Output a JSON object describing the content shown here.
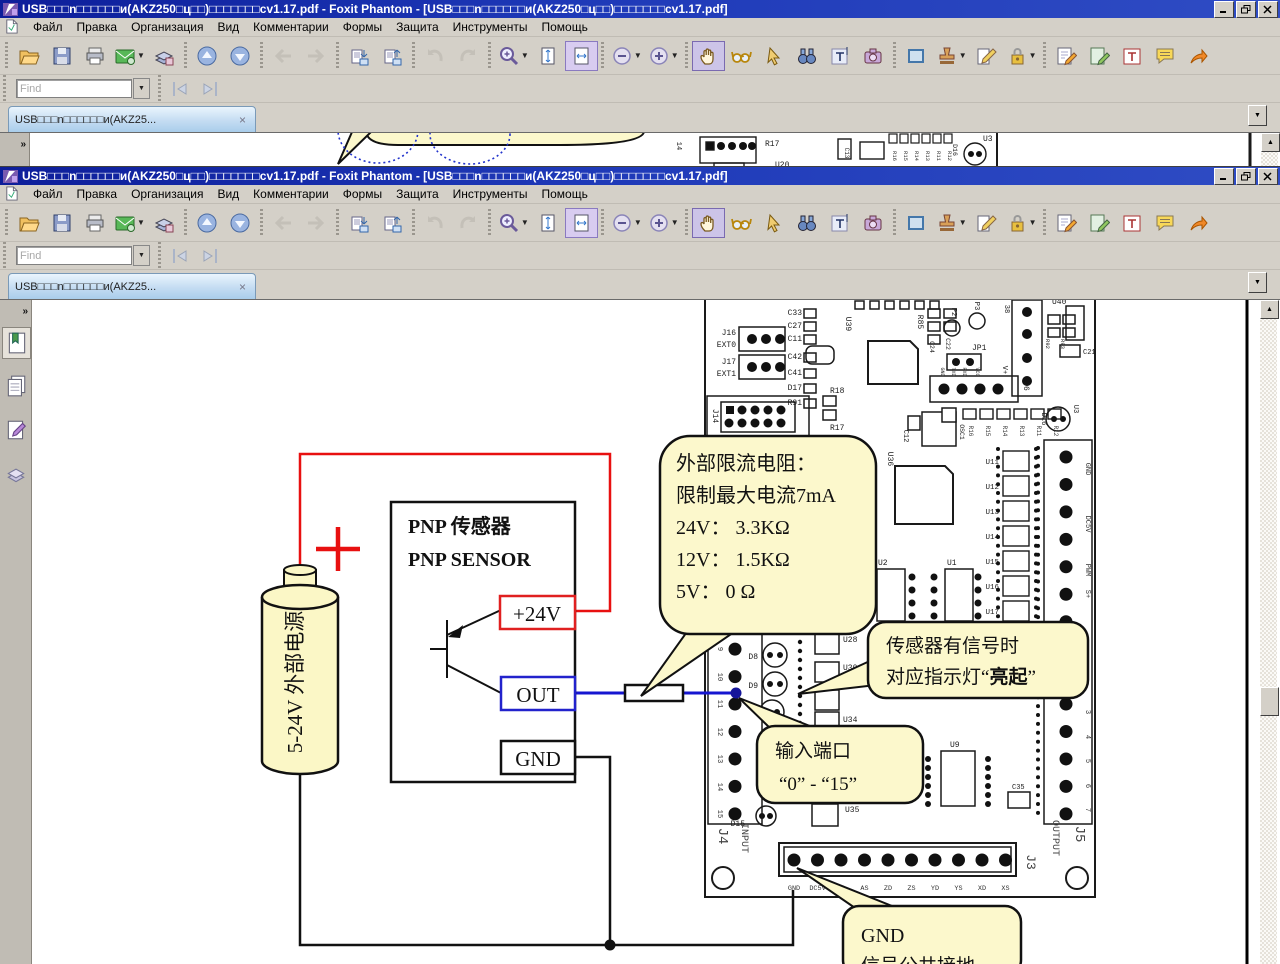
{
  "app": {
    "title": "USB□□□n□□□□□□и(AKZ250□ц□□)□□□□□□□cv1.17.pdf - Foxit Phantom - [USB□□□n□□□□□□и(AKZ250□ц□□)□□□□□□□cv1.17.pdf]",
    "menu": [
      "Файл",
      "Правка",
      "Организация",
      "Вид",
      "Комментарии",
      "Формы",
      "Защита",
      "Инструменты",
      "Помощь"
    ],
    "find_placeholder": "Find",
    "tab_label": "USB□□□n□□□□□□и(AKZ25...",
    "tab_close": "×",
    "overflow_glyph": "▼",
    "scroll_up_glyph": "▲",
    "expand_glyph": "»"
  },
  "toolbar": {
    "groups": [
      [
        {
          "icon": "open"
        },
        {
          "icon": "save"
        },
        {
          "icon": "print"
        },
        {
          "icon": "email",
          "dd": true
        },
        {
          "icon": "scan"
        }
      ],
      [
        {
          "icon": "page-up"
        },
        {
          "icon": "page-down"
        }
      ],
      [
        {
          "icon": "prev-view",
          "disabled": true
        },
        {
          "icon": "next-view",
          "disabled": true
        }
      ],
      [
        {
          "icon": "insert-pages"
        },
        {
          "icon": "extract-pages"
        }
      ],
      [
        {
          "icon": "undo",
          "disabled": true
        },
        {
          "icon": "redo",
          "disabled": true
        }
      ],
      [
        {
          "icon": "zoom-tool",
          "dd": true
        },
        {
          "icon": "fit-page"
        },
        {
          "icon": "fit-width",
          "fsel": true
        }
      ],
      [
        {
          "icon": "zoom-out",
          "dd": true
        },
        {
          "icon": "zoom-in",
          "dd": true
        }
      ],
      [
        {
          "icon": "hand",
          "selected": true
        },
        {
          "icon": "reading-mode"
        },
        {
          "icon": "select-annotation"
        },
        {
          "icon": "search"
        },
        {
          "icon": "select-text"
        },
        {
          "icon": "snapshot"
        }
      ],
      [
        {
          "icon": "link"
        },
        {
          "icon": "stamp",
          "dd": true
        },
        {
          "icon": "pencil"
        },
        {
          "icon": "encrypt",
          "dd": true
        }
      ],
      [
        {
          "icon": "edit-text"
        },
        {
          "icon": "edit-object"
        },
        {
          "icon": "typewriter"
        },
        {
          "icon": "note-comment"
        },
        {
          "icon": "share"
        }
      ]
    ]
  },
  "sidebar": {
    "items": [
      {
        "icon": "bookmarks"
      },
      {
        "icon": "pages"
      },
      {
        "icon": "comments"
      },
      {
        "icon": "attachments"
      }
    ]
  },
  "doc": {
    "battery_label": "5-24V 外部电源",
    "plus_sign": "+",
    "sensor_title_cn": "PNP 传感器",
    "sensor_title_en": "PNP SENSOR",
    "pin_24v": "+24V",
    "pin_out": "OUT",
    "pin_gnd": "GND",
    "callout_resistor": {
      "l1": "外部限流电阻：",
      "l2": "限制最大电流7mA",
      "l3": "24V： 3.3KΩ",
      "l4": "12V： 1.5KΩ",
      "l5": "5V： 0 Ω"
    },
    "callout_led": {
      "l1": "传感器有信号时",
      "l2_pre": "对应指示灯“",
      "l2_bold": "亮起",
      "l2_post": "”"
    },
    "callout_input": {
      "l1": "输入端口",
      "l2": "“0” - “15”"
    },
    "callout_gnd": {
      "l1": "GND",
      "l2": "信号公共接地"
    },
    "pcb": {
      "j16": "J16",
      "ext0": "EXT0",
      "j17": "J17",
      "ext1": "EXT1",
      "cap_col": [
        "C33",
        "C27",
        "C11",
        "C42",
        "C41",
        "D17",
        "R91"
      ],
      "u39": "U39",
      "j14": "J14",
      "r18": "R18",
      "r17": "R17",
      "r85": "R85",
      "c24": "C24",
      "c22": "C22",
      "p2": "P2",
      "p3": "P3",
      "jp1": "JP1",
      "jp1_pins": [
        "GND",
        "TXD",
        "RXD",
        "VCC"
      ],
      "j6": "J6",
      "n38": "38",
      "vplus": "V+",
      "r92": "R92",
      "r93": "R93",
      "u40": "U40",
      "c21": "C21",
      "u3": "U3",
      "d16": "D16",
      "c12": "C12",
      "osc1": "OSC1",
      "u36": "U36",
      "r_row": [
        "R16",
        "R15",
        "R14",
        "R13",
        "R11",
        "R12"
      ],
      "u_col": [
        "U11",
        "U12",
        "U13",
        "U14",
        "U15",
        "U16",
        "U17"
      ],
      "u2": "U2",
      "u1": "U1",
      "d8": "D8",
      "d9": "D9",
      "d15": "D15",
      "u28": "U28",
      "u30": "U30",
      "u34": "U34",
      "u35": "U35",
      "u9": "U9",
      "c35": "C35",
      "right_labels": [
        "GND",
        "DC5V",
        "PWM",
        "S+"
      ],
      "right_nums": [
        "3",
        "4",
        "5",
        "6",
        "7"
      ],
      "left_nums": [
        "9",
        "10",
        "11",
        "12",
        "13",
        "14",
        "15"
      ],
      "j4": "J4",
      "input": "INPUT",
      "j5": "J5",
      "output": "OUTPUT",
      "j3": "J3",
      "j3_pins": [
        "GND",
        "DC5V",
        "AD",
        "AS",
        "ZD",
        "ZS",
        "YD",
        "YS",
        "XD",
        "XS"
      ]
    },
    "strip": {
      "j14": "14",
      "r17": "R17",
      "u20": "U20",
      "c13": "C13",
      "d16": "D16",
      "u3": "U3",
      "r_row": [
        "R16",
        "R15",
        "R14",
        "R13",
        "R11",
        "R12"
      ]
    }
  }
}
